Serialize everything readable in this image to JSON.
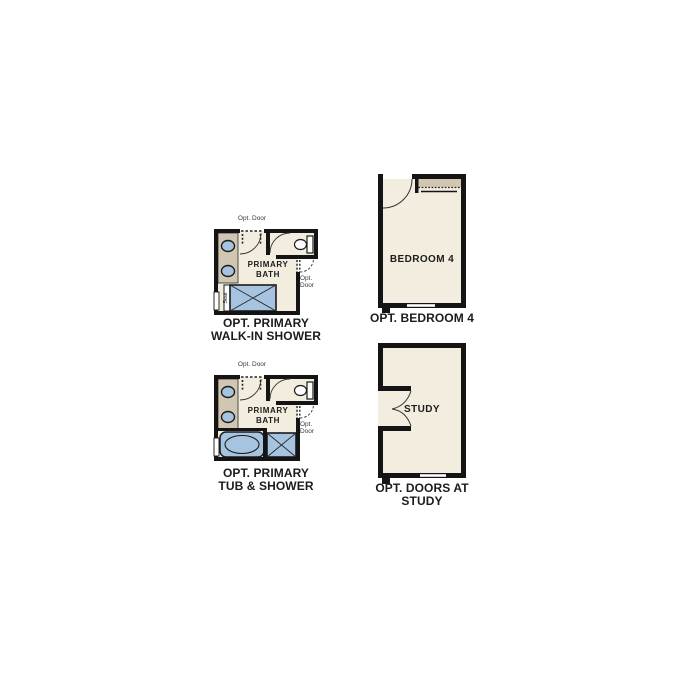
{
  "sheet": {
    "description_colors": {
      "page_background": "#ffffff",
      "wall": "#141414",
      "room_fill": "#f3ede0",
      "counter_tan": "#d1c6b1",
      "fixture_blue": "#a6c4e0",
      "caption_text": "#1c1c1c",
      "small_label_text": "#3a3a3a"
    }
  },
  "plans": {
    "walk_in_shower": {
      "opt_door_top_label": "Opt. Door",
      "opt_door_right_line1": "Opt.",
      "opt_door_right_line2": "Door",
      "room_line1": "PRIMARY",
      "room_line2": "BATH",
      "seat_label": "Seat",
      "caption_line1": "OPT. PRIMARY",
      "caption_line2": "WALK-IN SHOWER"
    },
    "tub_and_shower": {
      "opt_door_top_label": "Opt. Door",
      "opt_door_right_line1": "Opt.",
      "opt_door_right_line2": "Door",
      "room_line1": "PRIMARY",
      "room_line2": "BATH",
      "caption_line1": "OPT. PRIMARY",
      "caption_line2": "TUB & SHOWER"
    },
    "bedroom_4": {
      "room_label": "BEDROOM 4",
      "caption": "OPT. BEDROOM 4"
    },
    "study": {
      "room_label": "STUDY",
      "caption_line1": "OPT. DOORS AT",
      "caption_line2": "STUDY"
    }
  }
}
